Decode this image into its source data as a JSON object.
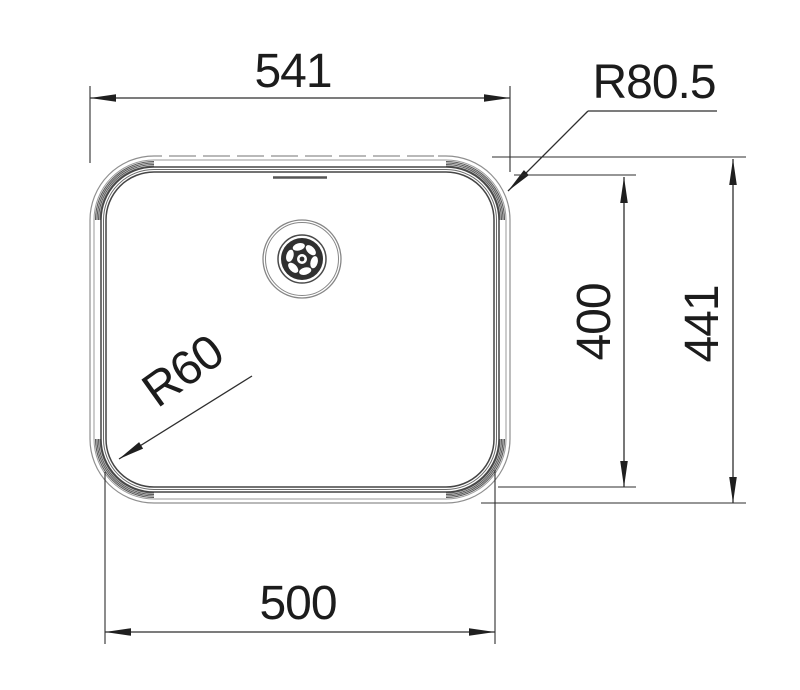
{
  "drawing": {
    "type": "technical-drawing",
    "subject": "undermount-sink-bowl-top-view",
    "labels": {
      "top_width": "541",
      "outer_corner_radius": "R80.5",
      "inner_height": "400",
      "outer_height": "441",
      "bottom_width": "500",
      "inner_corner_radius": "R60"
    },
    "colors": {
      "dimension_line": "#2e2e2e",
      "text": "#1c1c1c",
      "outline_light": "#8f8f8f",
      "outline_dark": "#454545",
      "background": "#ffffff"
    }
  }
}
